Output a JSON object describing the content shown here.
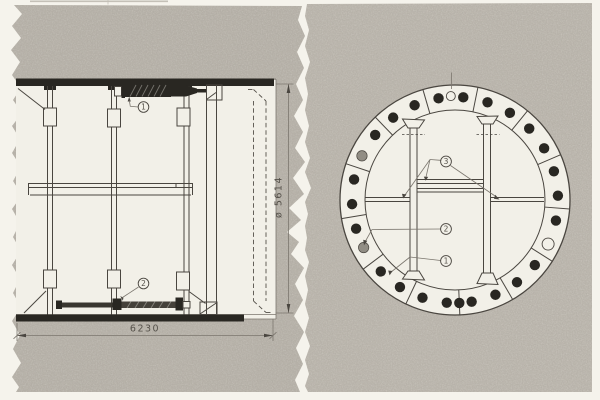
{
  "colors": {
    "bg": "#f5f3ec",
    "panel": "#b7b2a9",
    "panel2": "#bbb6ad",
    "paper": "#f2f0e8",
    "line": "#4a4640",
    "line-light": "#7b766e",
    "dark": "#292722",
    "text": "#55514a",
    "gray-bolt": "#918d84"
  },
  "side_view": {
    "callouts": [
      {
        "label": "1"
      },
      {
        "label": "2"
      }
    ],
    "dimensions": {
      "width_label": "6230",
      "diameter_label": "ø 5614"
    }
  },
  "cross_section": {
    "callouts": [
      {
        "label": "3"
      },
      {
        "label": "2"
      },
      {
        "label": "1"
      }
    ],
    "ring": {
      "center_x": 455,
      "center_y": 200,
      "outer_radius": 115,
      "inner_radius": 90,
      "bolt_orbit_radius": 103,
      "bolt_radius": 5.2,
      "joint_angles": [
        23.2,
        50.9,
        78.5,
        106.2,
        133.9,
        161.6,
        189.3,
        217.0,
        244.7,
        272.4,
        300.1,
        327.8,
        355.5
      ],
      "bolts": [
        {
          "angle": 2.4,
          "type": "dark"
        },
        {
          "angle": 16.2,
          "type": "dark"
        },
        {
          "angle": 30.1,
          "type": "dark"
        },
        {
          "angle": 43.9,
          "type": "dark"
        },
        {
          "angle": 57.8,
          "type": "dark"
        },
        {
          "angle": 71.6,
          "type": "dark"
        },
        {
          "angle": 85.4,
          "type": "dark"
        },
        {
          "angle": 99.2,
          "type": "dark"
        },
        {
          "angle": 113.1,
          "type": "dark"
        },
        {
          "angle": 126.9,
          "type": "dark"
        },
        {
          "angle": 140.8,
          "type": "dark"
        },
        {
          "angle": 154.6,
          "type": "gray"
        },
        {
          "angle": 168.5,
          "type": "dark"
        },
        {
          "angle": 182.3,
          "type": "dark"
        },
        {
          "angle": 196.2,
          "type": "dark"
        },
        {
          "angle": 207.5,
          "type": "gray"
        },
        {
          "angle": 223.9,
          "type": "dark"
        },
        {
          "angle": 237.7,
          "type": "dark"
        },
        {
          "angle": 251.6,
          "type": "dark"
        },
        {
          "angle": 265.4,
          "type": "dark"
        },
        {
          "angle": 272.4,
          "type": "dark"
        },
        {
          "angle": 279.3,
          "type": "dark"
        },
        {
          "angle": 293.1,
          "type": "dark"
        },
        {
          "angle": 307.0,
          "type": "dark"
        },
        {
          "angle": 320.8,
          "type": "dark"
        },
        {
          "angle": 334.7,
          "type": "open"
        },
        {
          "angle": 348.5,
          "type": "dark"
        }
      ],
      "grout_hole": {
        "angle": 92.3,
        "orbit": 104,
        "radius": 4.5
      }
    }
  }
}
